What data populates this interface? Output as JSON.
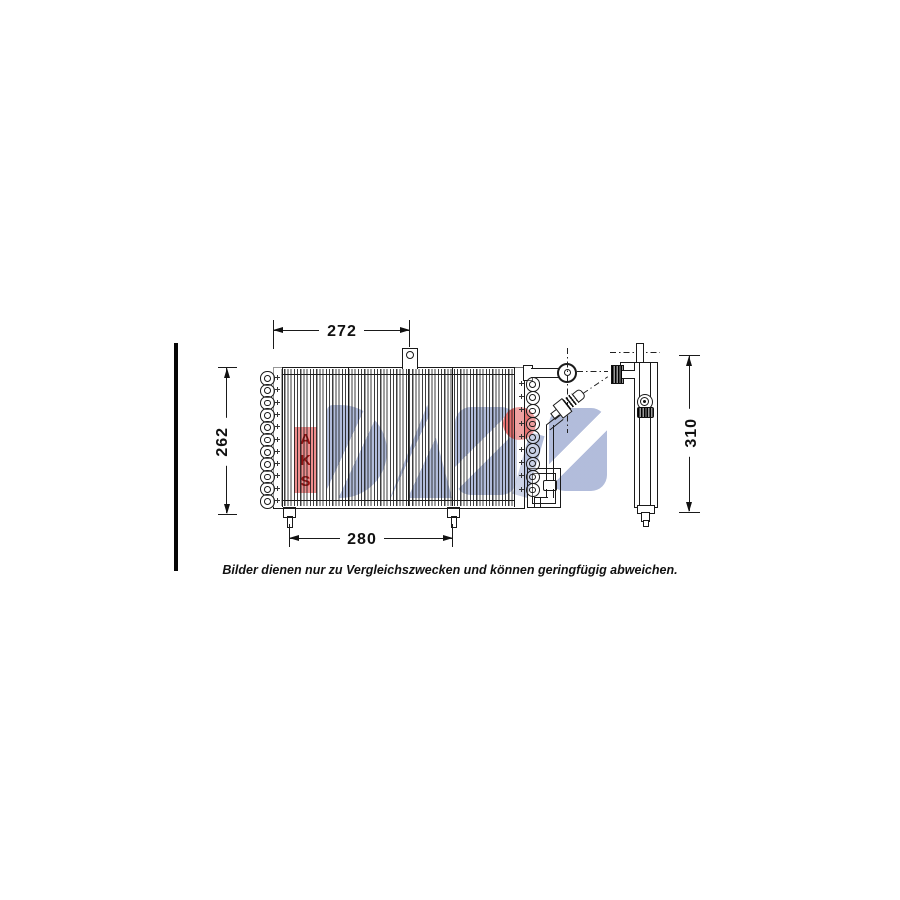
{
  "footer": {
    "disclaimer": "Bilder dienen nur zu Vergleichszwecken und können geringfügig abweichen."
  },
  "dimensions": {
    "top_width": "272",
    "left_height": "262",
    "bottom_width": "280",
    "drier_height": "310"
  },
  "watermark": {
    "brand": "DASIS",
    "company_letters": [
      "A",
      "K",
      "S"
    ],
    "brand_color": "#96a3cd",
    "accent_color": "#e05a5a"
  },
  "drawing": {
    "line_color": "#1a1a1a",
    "views": {
      "front": "condenser-front-view",
      "side": "receiver-drier-side-view"
    }
  }
}
